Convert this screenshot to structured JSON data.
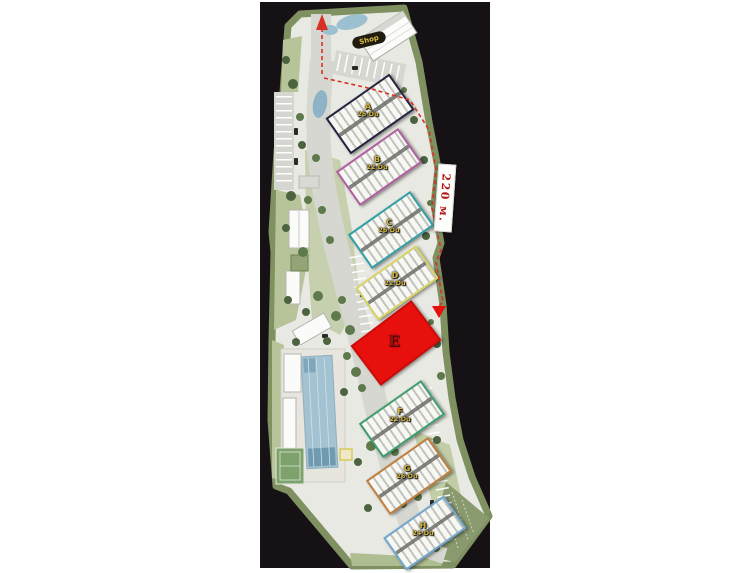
{
  "plan": {
    "shop_label": "Shop",
    "dimension_label": "220 м.",
    "buildings": [
      {
        "id": "A",
        "units": "25 Du",
        "outline": "#23233f"
      },
      {
        "id": "B",
        "units": "22 Du",
        "outline": "#b05fa0"
      },
      {
        "id": "C",
        "units": "26 Du",
        "outline": "#2f9fa6"
      },
      {
        "id": "D",
        "units": "22 Du",
        "outline": "#d6d463"
      },
      {
        "id": "E",
        "units": "",
        "outline": "#e8100c",
        "fill": "#e8100c"
      },
      {
        "id": "F",
        "units": "22 Du",
        "outline": "#3d9e6d"
      },
      {
        "id": "G",
        "units": "26 Du",
        "outline": "#bf7f3e"
      },
      {
        "id": "H",
        "units": "24 Du",
        "outline": "#71a6cd"
      }
    ],
    "colors": {
      "highlight": "#e8100c",
      "route": "#d93025",
      "label_text": "#d9b93f",
      "dimension_text": "#b51818"
    }
  }
}
